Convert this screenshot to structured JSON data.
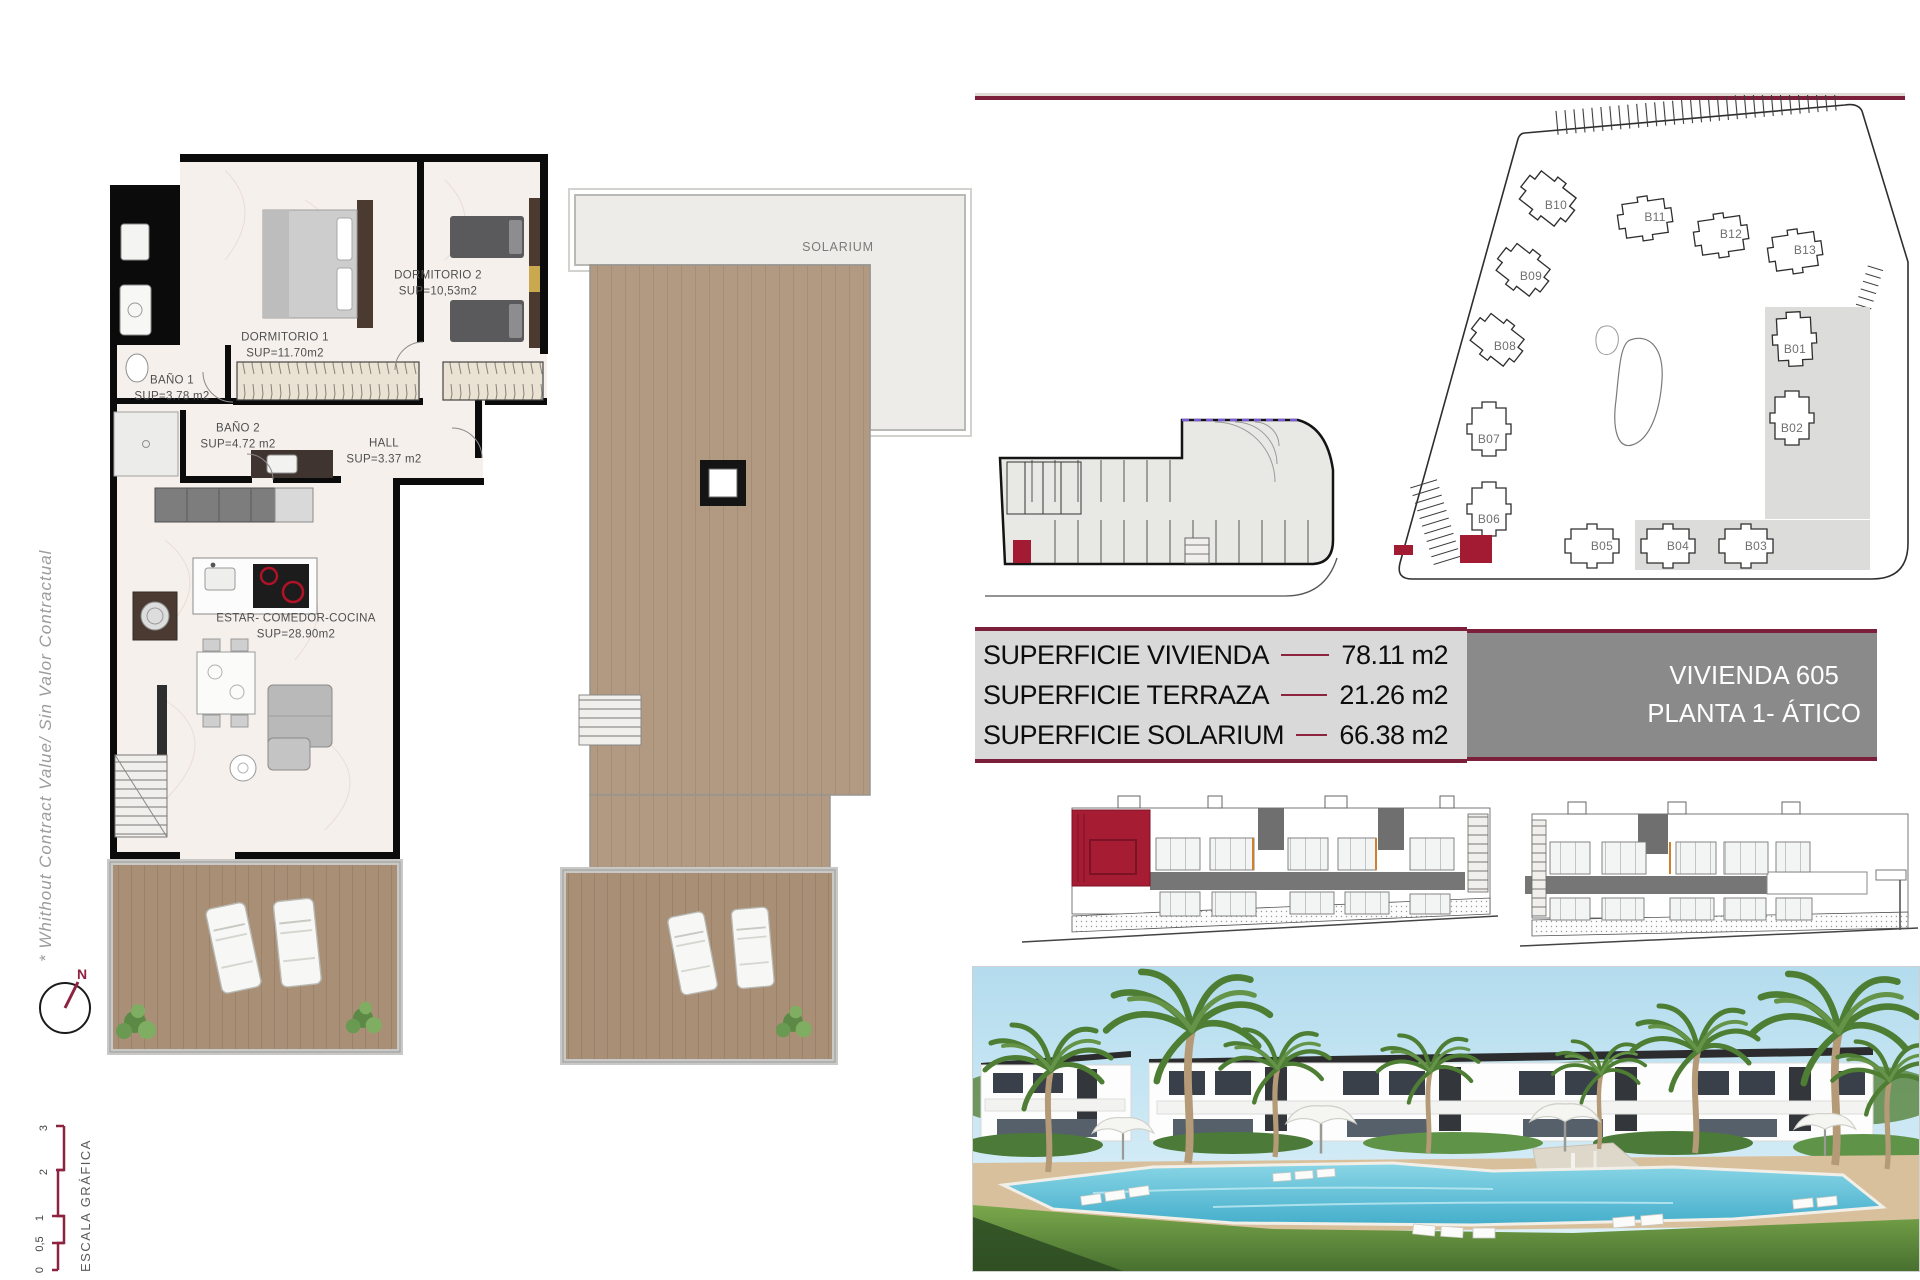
{
  "colors": {
    "accent_maroon": "#7c1f3a",
    "accent_line": "#8e2340",
    "highlight_red": "#a31b33",
    "table_bg": "#d9d9d9",
    "unit_box_bg": "#8a8a8a"
  },
  "side_annotations": {
    "disclaimer": "* Whithout Contract Value/ Sin Valor Contractual",
    "north_label": "N",
    "scale_title": "ESCALA GRÁFICA",
    "scale_ticks": [
      "3",
      "2",
      "1",
      "0,5",
      "0"
    ]
  },
  "floor_plan": {
    "rooms": [
      {
        "name": "DORMITORIO 1",
        "area": "SUP=11.70m2"
      },
      {
        "name": "DORMITORIO 2",
        "area": "SUP=10,53m2"
      },
      {
        "name": "BAÑO 1",
        "area": "SUP=3.78 m2"
      },
      {
        "name": "BAÑO 2",
        "area": "SUP=4.72 m2"
      },
      {
        "name": "HALL",
        "area": "SUP=3.37 m2"
      },
      {
        "name": "ESTAR- COMEDOR-COCINA",
        "area": "SUP=28.90m2"
      }
    ]
  },
  "solarium_plan": {
    "label": "SOLARIUM"
  },
  "site_plan": {
    "buildings": [
      {
        "label": "B01"
      },
      {
        "label": "B02"
      },
      {
        "label": "B03"
      },
      {
        "label": "B04"
      },
      {
        "label": "B05"
      },
      {
        "label": "B06"
      },
      {
        "label": "B07"
      },
      {
        "label": "B08"
      },
      {
        "label": "B09"
      },
      {
        "label": "B10"
      },
      {
        "label": "B11"
      },
      {
        "label": "B12"
      },
      {
        "label": "B13"
      }
    ]
  },
  "summary": {
    "rows": [
      {
        "label": "SUPERFICIE VIVIENDA",
        "value": "78.11 m2"
      },
      {
        "label": "SUPERFICIE TERRAZA",
        "value": "21.26 m2"
      },
      {
        "label": "SUPERFICIE SOLARIUM",
        "value": "66.38 m2"
      }
    ],
    "unit": {
      "line1": "VIVIENDA 605",
      "line2": "PLANTA 1- ÁTICO"
    }
  }
}
